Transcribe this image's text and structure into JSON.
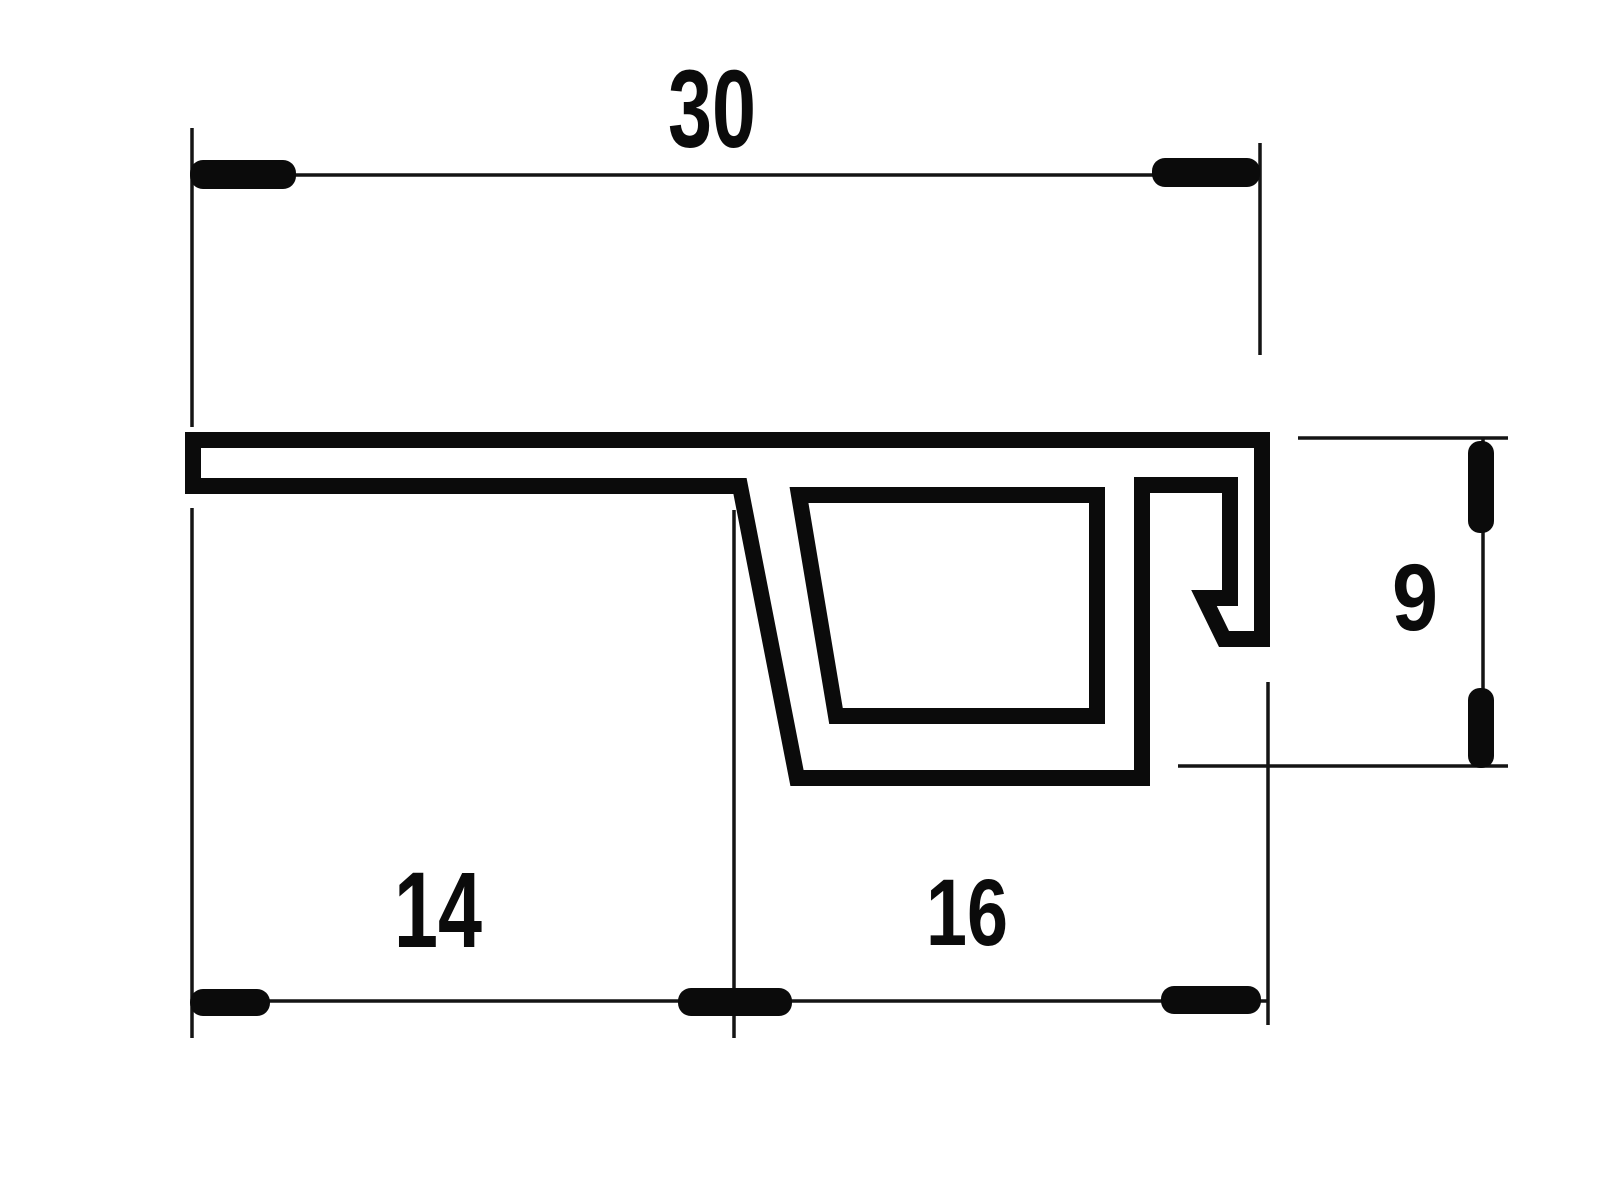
{
  "drawing": {
    "description": "technical cross-section drawing of an extruded trim profile with dimension lines",
    "background": "#ffffff",
    "ink_color": "#0b0b0b",
    "labels": {
      "total_width": "30",
      "left_segment": "14",
      "channel_segment": "16",
      "height": "9"
    }
  }
}
